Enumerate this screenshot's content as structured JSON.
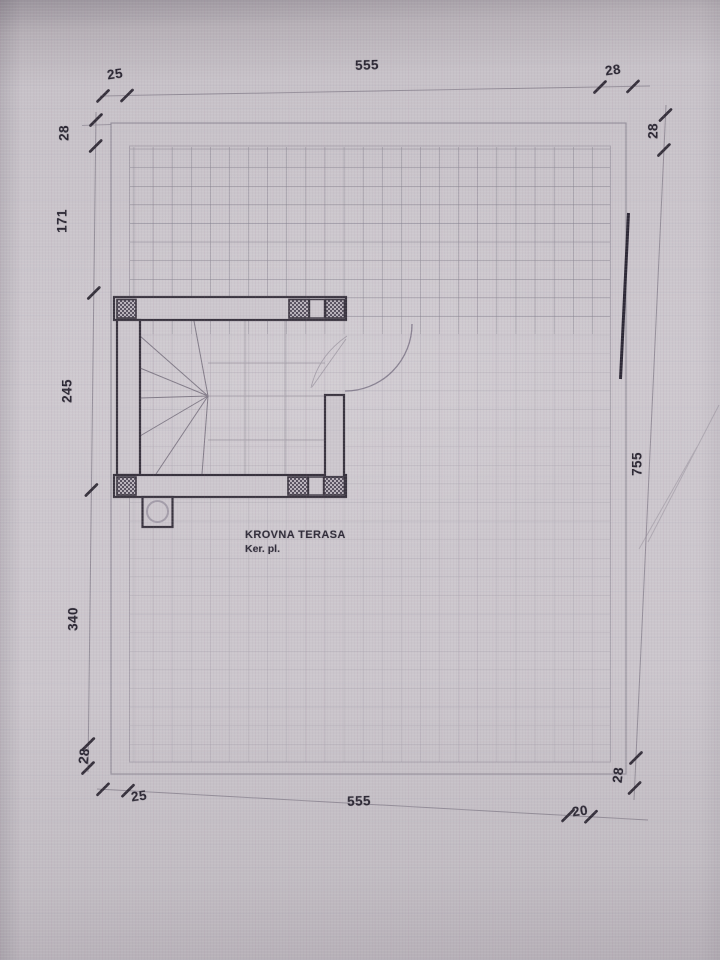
{
  "title": {
    "room": "KROVNA TERASA",
    "finish": "Ker. pl."
  },
  "dimensions": {
    "top": {
      "left_offset": "25",
      "span": "555",
      "right_wall": "28"
    },
    "right": {
      "top_wall": "28",
      "span": "755"
    },
    "bottom": {
      "left_offset": "25",
      "span": "555",
      "right_offset": "20",
      "right_wall": "28"
    },
    "left": {
      "top_wall": "28",
      "upper": "171",
      "stair": "245",
      "lower": "340",
      "bottom_wall": "28"
    }
  },
  "colors": {
    "paper": "#ccc7cd",
    "ink": "#39343f",
    "dim_ink": "#2b2733",
    "grid_line": "#5f5a6b",
    "hatch": "#57515f"
  }
}
